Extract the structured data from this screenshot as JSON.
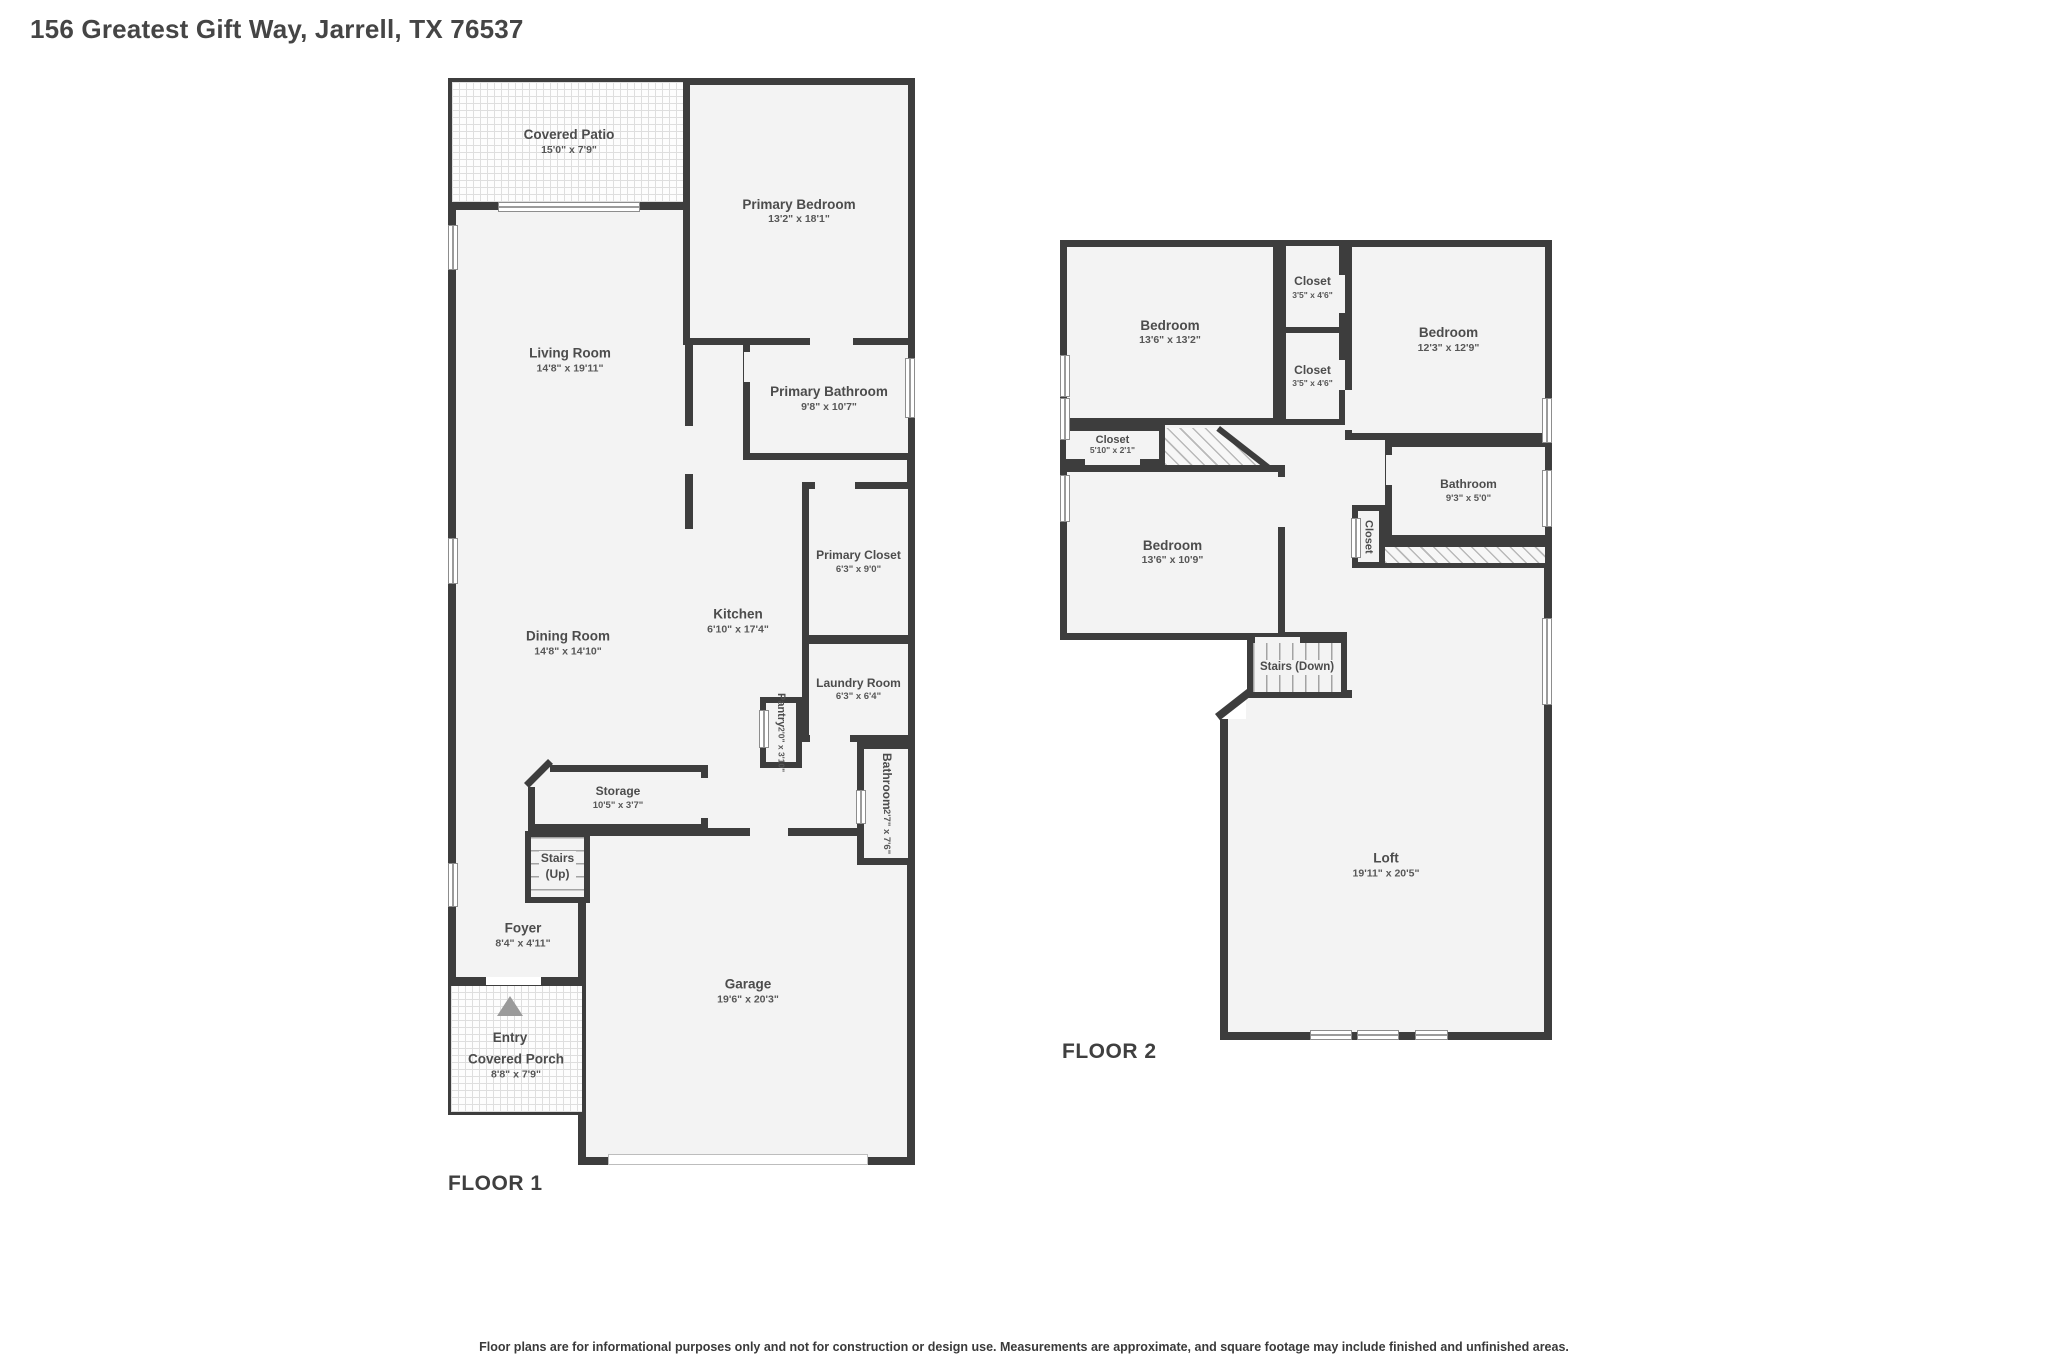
{
  "title": "156 Greatest Gift Way, Jarrell, TX 76537",
  "disclaimer": "Floor plans are for informational purposes only and not for construction or design use. Measurements are approximate, and square footage may include finished and unfinished areas.",
  "colors": {
    "wall": "#3d3d3d",
    "room_fill": "#f3f3f3",
    "hatch": "#dedede",
    "text": "#4c4c4c"
  },
  "floor1": {
    "label": "FLOOR 1",
    "rooms": {
      "covered_patio": {
        "name": "Covered Patio",
        "dims": "15'0\" x 7'9\""
      },
      "primary_bedroom": {
        "name": "Primary Bedroom",
        "dims": "13'2\" x 18'1\""
      },
      "living_room": {
        "name": "Living Room",
        "dims": "14'8\" x 19'11\""
      },
      "primary_bathroom": {
        "name": "Primary Bathroom",
        "dims": "9'8\" x 10'7\""
      },
      "primary_closet": {
        "name": "Primary Closet",
        "dims": "6'3\" x 9'0\""
      },
      "kitchen": {
        "name": "Kitchen",
        "dims": "6'10\" x 17'4\""
      },
      "dining_room": {
        "name": "Dining Room",
        "dims": "14'8\" x 14'10\""
      },
      "laundry_room": {
        "name": "Laundry Room",
        "dims": "6'3\" x 6'4\""
      },
      "pantry": {
        "name": "Pantry",
        "dims": "2'0\" x 3'10\""
      },
      "storage": {
        "name": "Storage",
        "dims": "10'5\" x 3'7\""
      },
      "stairs": {
        "name": "Stairs",
        "name2": "(Up)"
      },
      "bathroom": {
        "name": "Bathroom",
        "dims": "2'7\" x 7'6\""
      },
      "foyer": {
        "name": "Foyer",
        "dims": "8'4\" x 4'11\""
      },
      "garage": {
        "name": "Garage",
        "dims": "19'6\" x 20'3\""
      },
      "entry": {
        "name": "Entry"
      },
      "covered_porch": {
        "name": "Covered Porch",
        "dims": "8'8\" x 7'9\""
      }
    }
  },
  "floor2": {
    "label": "FLOOR 2",
    "rooms": {
      "bedroom_1": {
        "name": "Bedroom",
        "dims": "13'6\" x 13'2\""
      },
      "closet_1": {
        "name": "Closet",
        "dims": "3'5\" x 4'6\""
      },
      "closet_2": {
        "name": "Closet",
        "dims": "3'5\" x 4'6\""
      },
      "bedroom_2": {
        "name": "Bedroom",
        "dims": "12'3\" x 12'9\""
      },
      "closet_3": {
        "name": "Closet",
        "dims": "5'10\" x 2'1\""
      },
      "bedroom_3": {
        "name": "Bedroom",
        "dims": "13'6\" x 10'9\""
      },
      "bathroom": {
        "name": "Bathroom",
        "dims": "9'3\" x 5'0\""
      },
      "closet_4": {
        "name": "Closet"
      },
      "stairs": {
        "name": "Stairs (Down)"
      },
      "loft": {
        "name": "Loft",
        "dims": "19'11\" x 20'5\""
      }
    }
  }
}
